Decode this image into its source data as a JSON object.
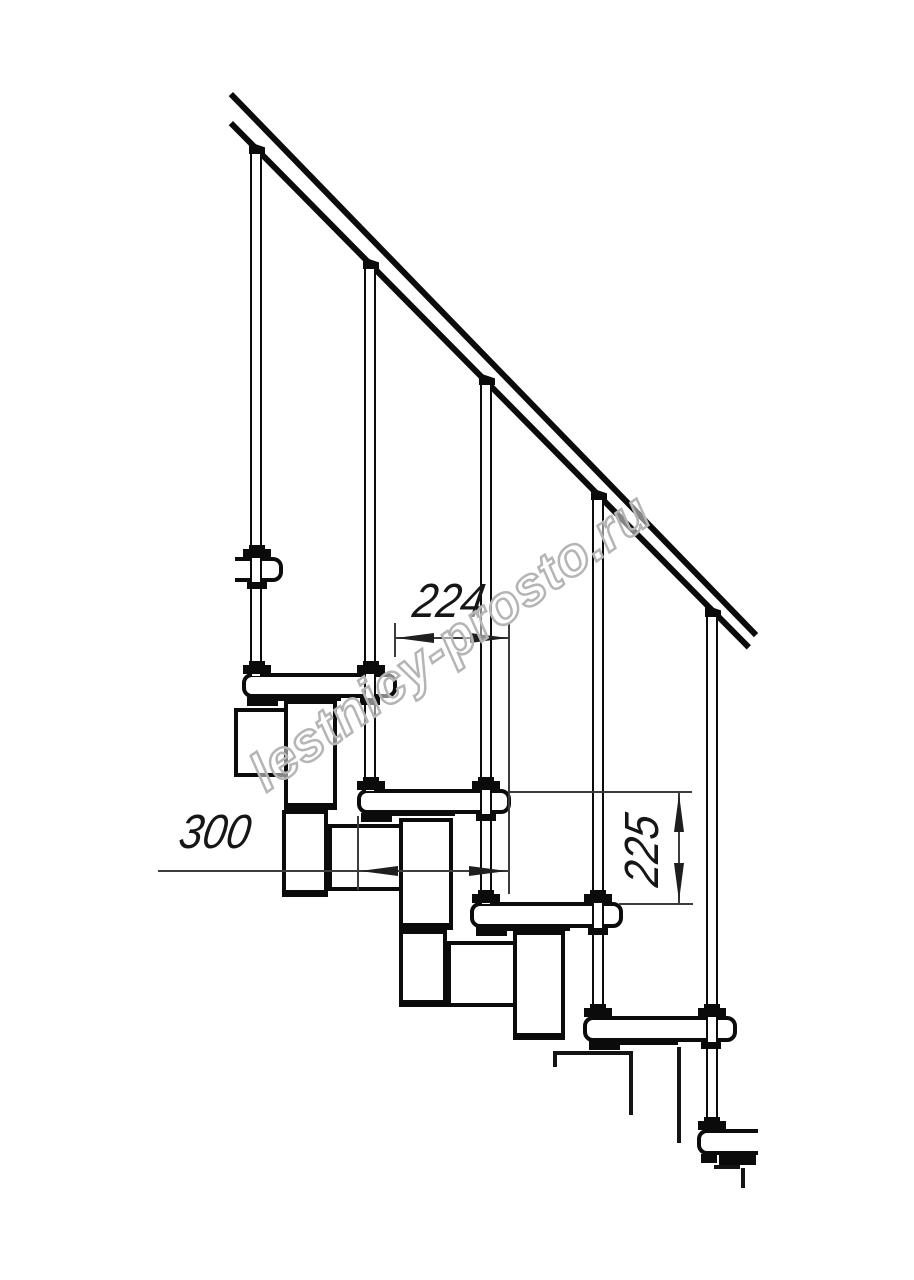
{
  "drawing": {
    "dimensions": {
      "upper_run": "224",
      "tread_length": "300",
      "riser_height": "225"
    },
    "watermark": {
      "text": "lestnicy-prosto.ru"
    },
    "colors": {
      "line": "#0b0b0b",
      "dimension_line": "#3c3c3c",
      "watermark_outline": "#b5b5b5",
      "background": "#ffffff"
    }
  }
}
